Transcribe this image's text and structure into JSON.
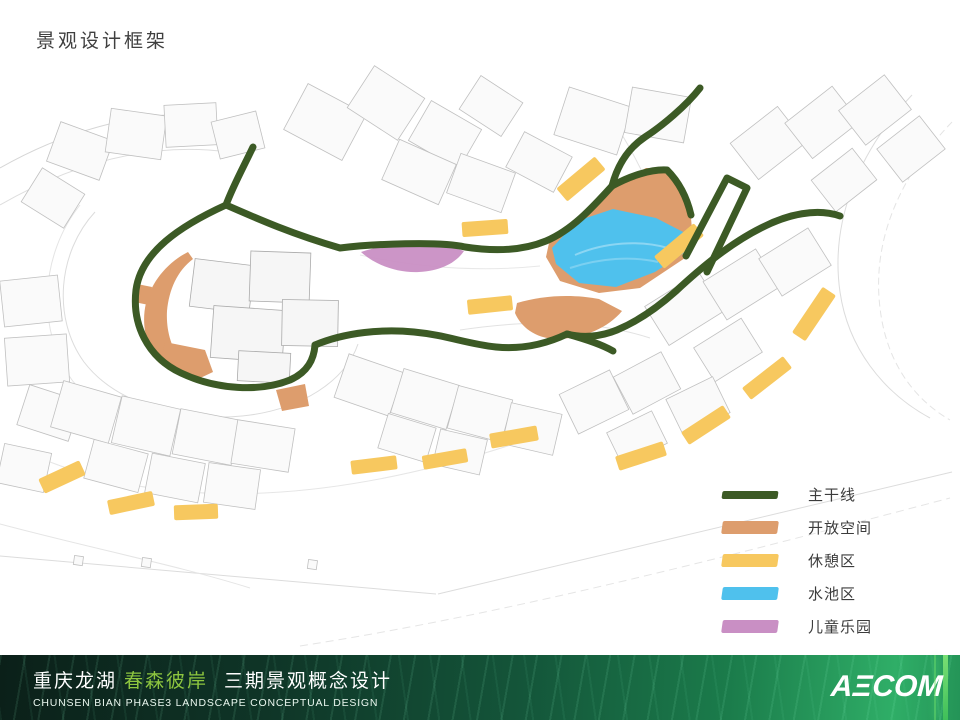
{
  "page": {
    "title": "景观设计框架"
  },
  "palette": {
    "main_line": "#3c5a25",
    "open_space": "#dd9d6d",
    "rest_area": "#f7c85f",
    "water_pool": "#4fc1ed",
    "children_park": "#c98fc4"
  },
  "legend": {
    "items": [
      {
        "key": "main_line",
        "label": "主干线",
        "swatch": "line"
      },
      {
        "key": "open_space",
        "label": "开放空间",
        "swatch": "area"
      },
      {
        "key": "rest_area",
        "label": "休憩区",
        "swatch": "area"
      },
      {
        "key": "water_pool",
        "label": "水池区",
        "swatch": "area"
      },
      {
        "key": "children_park",
        "label": "儿童乐园",
        "swatch": "area"
      }
    ]
  },
  "footer": {
    "cn_part1": "重庆龙湖",
    "cn_highlight": "春森彼岸",
    "cn_part2": "三期景观概念设计",
    "en_line": "CHUNSEN BIAN PHASE3  LANDSCAPE  CONCEPTUAL DESIGN",
    "logo_text": "AECOM",
    "accent_green": "#8dc63f"
  },
  "map": {
    "main_lines": [
      "M253 147 C244 166 233 186 226 205",
      "M226 205 C180 226 141 252 136 290 C132 324 147 357 181 373 C217 390 260 392 290 380 C308 372 314 359 315 345",
      "M226 205 C258 219 292 234 340 248 C372 244 440 241 465 247 C497 252 524 250 546 241 C572 230 592 208 612 186",
      "M700 88 C686 106 662 126 645 137 C627 149 617 167 612 186",
      "M612 186 C630 176 651 169 667 170 C679 182 687 198 691 215",
      "M686 256 L727 178 L747 188 L707 272",
      "M840 216 C817 208 788 214 761 228 C731 243 703 266 676 291 C657 308 636 322 617 330 C600 337 582 338 567 334 C542 346 517 349 496 347 C467 344 446 335 414 332 C383 329 346 332 315 345",
      "M567 334 C585 339 601 344 613 351"
    ],
    "open_spaces": [
      "M188 252 C168 262 152 281 146 303 C141 324 146 347 159 363 L171 371 L182 362 C171 348 166 330 167 311 C169 290 177 271 193 259 Z",
      "M137 284 L152 287 L149 305 L134 302 Z",
      "M165 342 L205 350 L213 372 L196 380 L160 362 Z",
      "M276 390 L305 384 L309 406 L282 411 Z",
      "M612 186 L646 168 L668 168 L690 207 L693 240 L685 258 L640 288 L599 293 L560 281 L546 257 L549 243 L575 228 Z",
      "M517 303 C543 295 574 294 599 299 L622 311 C609 327 584 339 555 339 C535 338 521 327 515 313 Z"
    ],
    "water_pools": [
      "M552 248 L577 221 L613 209 L656 218 L687 234 L690 249 L655 272 L616 287 L579 283 L556 264 Z"
    ],
    "children_parks": [
      "M361 252 C379 246 401 243 421 244 C441 245 456 248 464 251 C456 263 440 271 419 272 C397 273 375 265 361 252 Z"
    ],
    "rest_areas": [
      {
        "cx": 485,
        "cy": 228,
        "w": 46,
        "h": 15,
        "rot": -4
      },
      {
        "cx": 581,
        "cy": 179,
        "w": 50,
        "h": 17,
        "rot": -40
      },
      {
        "cx": 490,
        "cy": 305,
        "w": 45,
        "h": 15,
        "rot": -6
      },
      {
        "cx": 679,
        "cy": 246,
        "w": 52,
        "h": 16,
        "rot": -40
      },
      {
        "cx": 814,
        "cy": 314,
        "w": 55,
        "h": 16,
        "rot": -56
      },
      {
        "cx": 767,
        "cy": 378,
        "w": 52,
        "h": 15,
        "rot": -38
      },
      {
        "cx": 706,
        "cy": 425,
        "w": 50,
        "h": 15,
        "rot": -33
      },
      {
        "cx": 641,
        "cy": 456,
        "w": 50,
        "h": 15,
        "rot": -18
      },
      {
        "cx": 514,
        "cy": 437,
        "w": 48,
        "h": 15,
        "rot": -10
      },
      {
        "cx": 374,
        "cy": 465,
        "w": 46,
        "h": 14,
        "rot": -7
      },
      {
        "cx": 445,
        "cy": 459,
        "w": 45,
        "h": 14,
        "rot": -10
      },
      {
        "cx": 62,
        "cy": 477,
        "w": 45,
        "h": 16,
        "rot": -25
      },
      {
        "cx": 131,
        "cy": 503,
        "w": 46,
        "h": 15,
        "rot": -12
      },
      {
        "cx": 196,
        "cy": 512,
        "w": 44,
        "h": 15,
        "rot": -2
      }
    ]
  }
}
